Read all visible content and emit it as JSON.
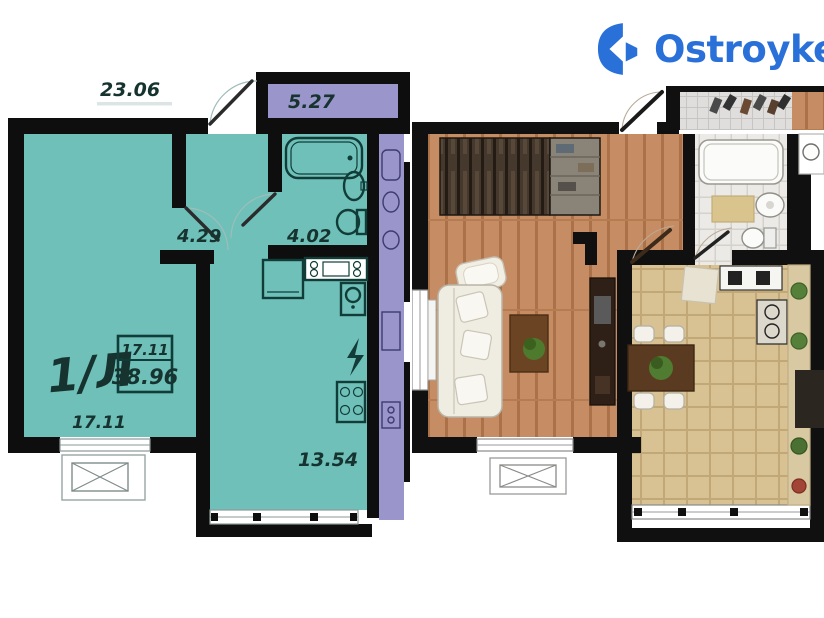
{
  "logo": {
    "text": "Ostroyke",
    "brand_color": "#2a70d9"
  },
  "left_plan": {
    "apartment_label": "1/Л",
    "area_table": {
      "living_area": "17.11",
      "total_area": "38.96"
    },
    "dimensions": {
      "top_width": "23.06",
      "corridor": "5.27",
      "hallway": "4.29",
      "bathroom": "4.02",
      "living_room": "17.11",
      "kitchen": "13.54"
    },
    "colors": {
      "apartment_fill": "#6fc0b9",
      "neighbor_fill": "#9a95cb",
      "wall": "#0e0e0e",
      "label": "#16332f"
    }
  },
  "right_plan": {
    "colors": {
      "wood_floor": "#c68c63",
      "kitchen_tile": "#d8c294",
      "bathroom_tile": "#ebeae6"
    }
  }
}
